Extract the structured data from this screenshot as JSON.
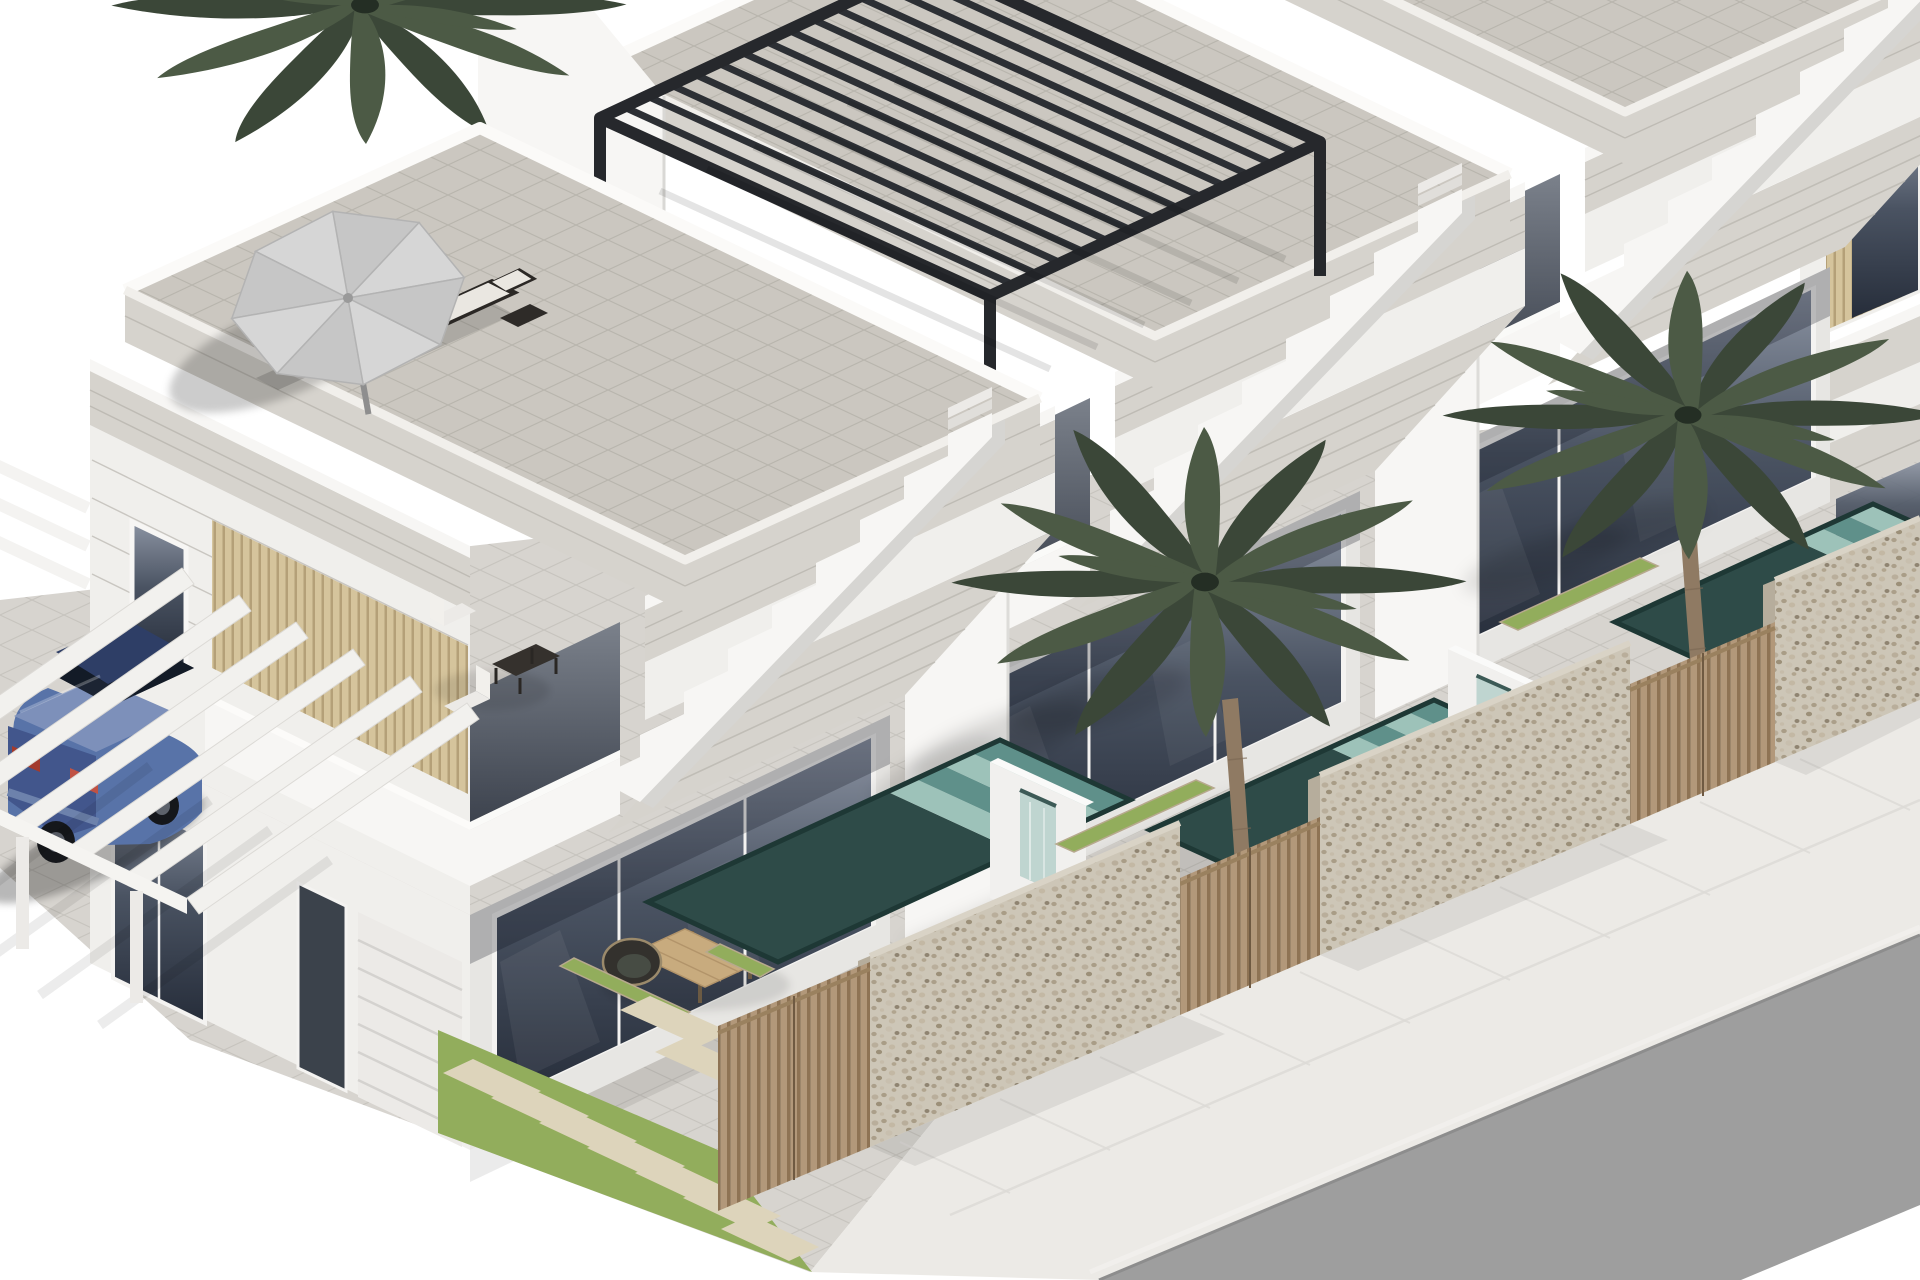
{
  "meta": {
    "type": "3d-architectural-render",
    "subject": "Row of modern white two-storey new-build villas with roof terraces, private patios with plunge pools, palm trees, stone boundary walls and a street at the lower right",
    "view": "isometric aerial",
    "background": "white"
  },
  "colors": {
    "background": "#ffffff",
    "pavement": "#d7d4cf",
    "sidewalk": "#eceae6",
    "road": "#9e9e9e",
    "road_edge": "#8d8d8d",
    "curb": "#f1efec",
    "wall_bright": "#f7f6f4",
    "wall_white": "#f0efec",
    "wall_shade": "#e7e6e3",
    "wall_dark": "#d8d7d4",
    "stone_band": "#d6d3cd",
    "stone_line": "#b9b6af",
    "slat_beige": "#d5c49c",
    "slat_beige_line": "#b4a078",
    "gate_wood": "#b2987a",
    "gate_wood_line": "#8e7354",
    "pebble_base": "#cdc6b7",
    "pebble_dark": "#a79c87",
    "glass_top": "#8b93a2",
    "glass_mid": "#4a5362",
    "glass_bottom": "#262d3a",
    "glass_frame": "#f4f3f1",
    "recess_top": "#7b818b",
    "recess_bottom": "#3d434e",
    "pergola_black": "#26282c",
    "deck_tile": "#cbc7c0",
    "pool_deep": "#2e4b48",
    "pool_stripe_light": "#9dc2b9",
    "pool_stripe_mid": "#5f908a",
    "pool_rim": "#1e3835",
    "cascade": "#bcd3cd",
    "grass": "#92ad5c",
    "paver": "#ddd4bb",
    "palm_dark": "#3b4738",
    "palm_mid": "#4c5a45",
    "trunk": "#8f7a63",
    "car_body": "#5873a8",
    "car_rear": "#42568c",
    "car_roof": "#2e3e66",
    "car_glass": "#141b27",
    "car_boot": "#7d90ba",
    "tail_red": "#a33a2d",
    "parasol_a": "#d6d6d6",
    "parasol_b": "#c6c6c6",
    "furniture_dark": "#2b2825",
    "cushion": "#eae7e1",
    "wood_table": "#c8ab7e"
  },
  "scene": {
    "villas": [
      {
        "name": "villa-1",
        "roof": "terrace with grey parasol and two dark sun loungers",
        "features": [
          "stone-clad cantilevered balcony soffit",
          "white staircase with stepped parapet to the roof",
          "first-floor corner terrace with white chairs and dark table",
          "garage with white sectional door",
          "carport pergola of white beams",
          "floor-to-ceiling dark glazing",
          "ground patio with two wicker chairs and wooden coffee table"
        ]
      },
      {
        "name": "villa-2",
        "roof": "terrace with black louvered pergola",
        "features": [
          "same repeating module",
          "patio with palm tree and plunge pool"
        ]
      },
      {
        "name": "villa-3",
        "roof": "terrace cropped at top of image",
        "features": [
          "same repeating module",
          "patio with palm tree and plunge pool"
        ]
      },
      {
        "name": "villa-4",
        "roof": "edge of next identical unit at right margin",
        "features": [
          "partially visible"
        ]
      }
    ],
    "street": {
      "road": "grey asphalt band across the lower-right corner",
      "sidewalk": "light paved walk between plot walls and road",
      "boundary": "rubble-stone walls alternating with vertical timber-slat gates"
    },
    "landscape": {
      "palm_trees": 3,
      "lawn": "green strip with diagonal row of stepping pavers",
      "planters": "narrow grass planters beside the pools"
    },
    "pools": [
      {
        "name": "pool-1",
        "style": "teal plunge pool with striped submerged steps and white waterfall wall"
      },
      {
        "name": "pool-2",
        "style": "same, partly hidden behind stone wall"
      },
      {
        "name": "pool-3",
        "style": "same, cropped at right edge"
      }
    ],
    "vehicle": {
      "type": "sedan",
      "color": "blue",
      "position": "parked on driveway under carport beams, lower left"
    }
  }
}
